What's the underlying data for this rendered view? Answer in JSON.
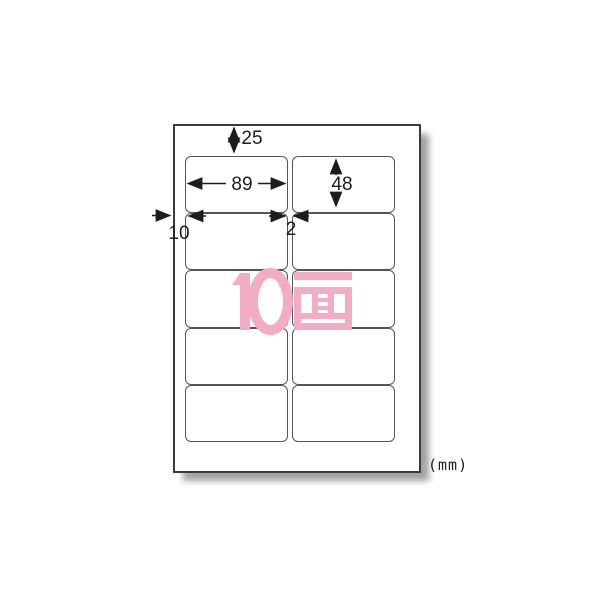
{
  "theme": {
    "pink": "#f2adc5",
    "ink": "#1d1d1d",
    "sheetBorder": "#3b3b3b",
    "cellBorder": "#555555"
  },
  "unit_note": "(mm)",
  "sheet": {
    "type": "A4 label sheet diagram",
    "label_count_text": "10面",
    "grid": {
      "rows": 5,
      "cols": 2
    }
  },
  "dimensions": {
    "top_margin": {
      "value": "25"
    },
    "label_width": {
      "value": "89"
    },
    "label_height": {
      "value": "48"
    },
    "left_margin": {
      "value": "10"
    },
    "column_gap": {
      "value": "2"
    }
  }
}
